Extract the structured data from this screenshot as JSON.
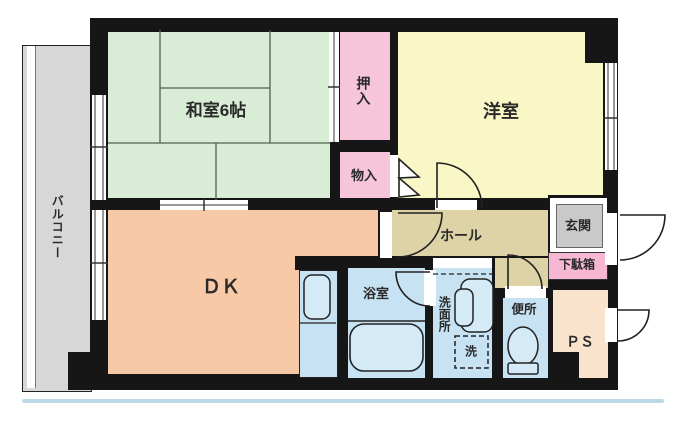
{
  "title": "apartment-floor-plan",
  "rooms": {
    "washitsu": {
      "label": "和室6帖",
      "color": "#d9ecd6"
    },
    "oshiire": {
      "label": "押入",
      "color": "#f6c5da"
    },
    "monoire": {
      "label": "物入",
      "color": "#f6c5da"
    },
    "yoshitsu": {
      "label": "洋室",
      "color": "#faf7c6"
    },
    "dk": {
      "label": "ＤＫ",
      "color": "#f8c9a6"
    },
    "hall": {
      "label": "ホール",
      "color": "#ddd3a6"
    },
    "genkan": {
      "label": "玄関",
      "color": "#c9c9c9"
    },
    "getabako": {
      "label": "下駄箱",
      "color": "#f5b7d1"
    },
    "yokushitsu": {
      "label": "浴室",
      "color": "#c7e3f3"
    },
    "senmenjo": {
      "label": "洗面所",
      "color": "#c7e3f3"
    },
    "washer": {
      "label": "洗"
    },
    "benjo": {
      "label": "便所",
      "color": "#c7e3f3"
    },
    "ps": {
      "label": "ＰＳ",
      "color": "#f9e3cd"
    },
    "balcony": {
      "label": "バルコニー",
      "color": "#d7d7d7"
    }
  },
  "features": {
    "doors": [
      "yoshitsu-door",
      "dk-hall-door",
      "bath-door",
      "toilet-door",
      "front-door",
      "ps-door",
      "monoire-bifold-door",
      "washitsu-dk-sliding-door",
      "oshiire-sliding-door"
    ],
    "windows": [
      "washitsu-balcony-window",
      "dk-balcony-window",
      "yoshitsu-side-window"
    ],
    "fixtures": [
      "bathtub",
      "toilet",
      "washbasin",
      "washing-machine-space",
      "kitchen-sink-unit"
    ]
  },
  "colors": {
    "wall": "#161616",
    "fixture_fill": "#d4ebf7",
    "baseline": "#bcd9e8",
    "tatami_line": "#51624f"
  }
}
